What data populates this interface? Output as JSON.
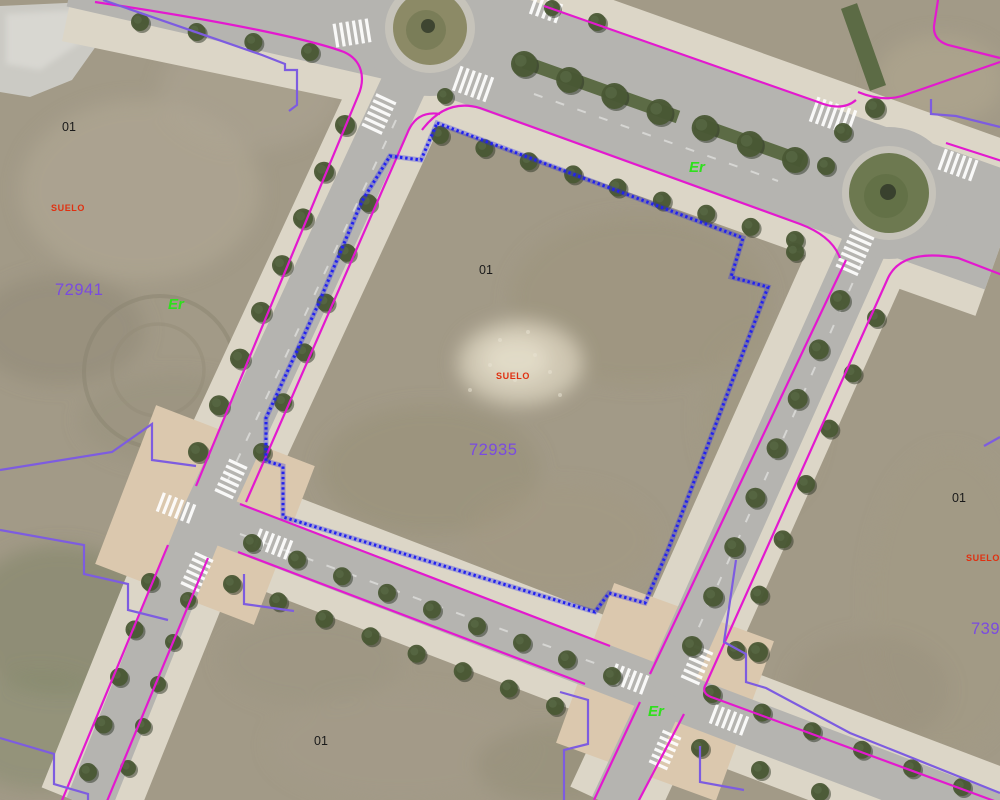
{
  "title": "Aerial cadastral map view",
  "labels": {
    "parcel_topleft_01": {
      "text": "01"
    },
    "suelo_left": {
      "text": "SUELO"
    },
    "refnum_left": {
      "text": "72941"
    },
    "er_left": {
      "text": "Er"
    },
    "parcel_center_01": {
      "text": "01"
    },
    "suelo_center": {
      "text": "SUELO"
    },
    "refnum_center": {
      "text": "72935"
    },
    "er_avenue": {
      "text": "Er"
    },
    "parcel_right_01": {
      "text": "01"
    },
    "suelo_right": {
      "text": "SUELO"
    },
    "refnum_right": {
      "text": "7393"
    },
    "er_bottom": {
      "text": "Er"
    },
    "parcel_bottom_01": {
      "text": "01"
    }
  },
  "colors": {
    "cadastral_line_magenta": "#e319cf",
    "parcel_line_purple": "#7d5ce0",
    "selected_parcel_blue": "#2222ee",
    "suelo_red": "#e03010",
    "refnum_purple": "#7a4be0",
    "er_green": "#2ee01c",
    "label_black": "#1a1a1a"
  }
}
